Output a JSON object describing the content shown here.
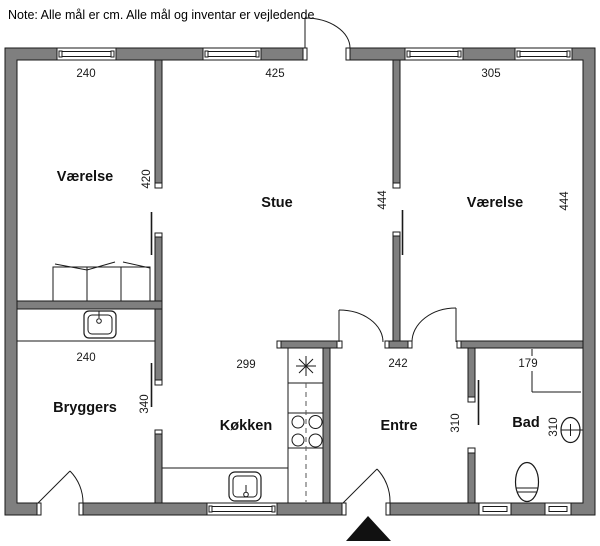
{
  "note": {
    "text": "Note: Alle mål er cm. Alle mål og inventar er vejledende"
  },
  "rooms": {
    "vaerelse_left": {
      "name": "Værelse",
      "width_cm": "240",
      "depth_cm": "420"
    },
    "stue": {
      "name": "Stue",
      "width_cm": "425",
      "depth_cm": "444"
    },
    "vaerelse_right": {
      "name": "Værelse",
      "width_cm": "305",
      "depth_cm": "444"
    },
    "bryggers": {
      "name": "Bryggers",
      "width_cm": "240",
      "depth_cm": "340"
    },
    "koekken": {
      "name": "Køkken",
      "width_cm": "299"
    },
    "entre": {
      "name": "Entre",
      "width_cm": "242",
      "depth_cm": "310"
    },
    "bad": {
      "name": "Bad",
      "width_cm": "179",
      "depth_cm": "310"
    }
  },
  "fixtures": [
    "wardrobe",
    "utility-sink",
    "floor-drain-star",
    "dishwasher-dashed-line",
    "cooktop-4-burner",
    "kitchen-sink",
    "toilet",
    "washbasin",
    "north-arrow"
  ],
  "colors": {
    "wall": "#7f7f7f",
    "line": "#1a1a1a",
    "background": "#ffffff",
    "north_arrow": "#111111"
  }
}
